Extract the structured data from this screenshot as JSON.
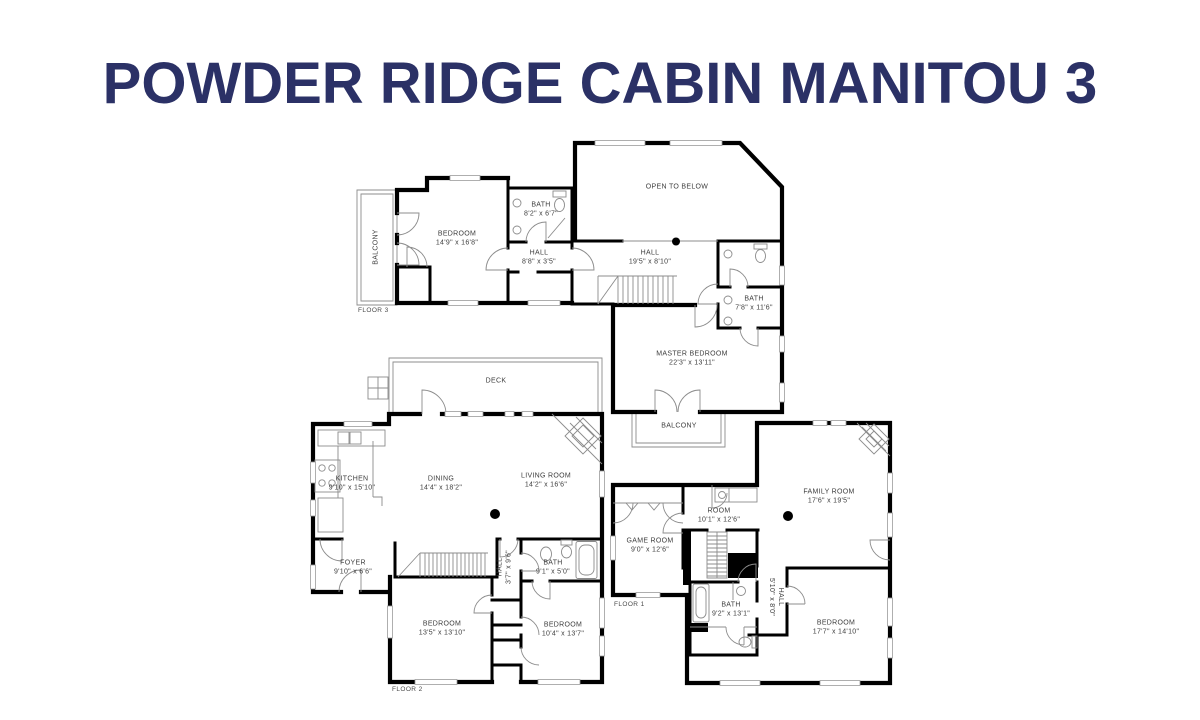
{
  "title": "POWDER RIDGE CABIN MANITOU 3",
  "colors": {
    "title": "#2b3166",
    "wall": "#000000",
    "thin": "#8c8c8c",
    "label": "#3d3d3d",
    "floor_label": "#4a4a4a"
  },
  "floor3": {
    "floor_label": "FLOOR 3",
    "rooms": {
      "balcony": {
        "name": "BALCONY"
      },
      "bedroom": {
        "name": "BEDROOM",
        "dims": "14'9\" x 16'8\""
      },
      "bath": {
        "name": "BATH",
        "dims": "8'2\" x 6'7\""
      },
      "hall": {
        "name": "HALL",
        "dims": "8'8\" x 3'5\""
      },
      "open_to_below": {
        "name": "OPEN TO BELOW"
      },
      "hall_main": {
        "name": "HALL",
        "dims": "19'5\" x 8'10\""
      },
      "bath_main": {
        "name": "BATH",
        "dims": "7'8\" x 11'6\""
      },
      "master_bedroom": {
        "name": "MASTER BEDROOM",
        "dims": "22'3\" x 13'11\""
      },
      "balcony_lower": {
        "name": "BALCONY"
      }
    }
  },
  "floor2": {
    "floor_label": "FLOOR 2",
    "rooms": {
      "deck": {
        "name": "DECK"
      },
      "kitchen": {
        "name": "KITCHEN",
        "dims": "9'10\" x 15'10\""
      },
      "dining": {
        "name": "DINING",
        "dims": "14'4\" x 18'2\""
      },
      "living_room": {
        "name": "LIVING ROOM",
        "dims": "14'2\" x 16'6\""
      },
      "foyer": {
        "name": "FOYER",
        "dims": "9'10\" x 6'6\""
      },
      "hall": {
        "name": "HALL",
        "dims": "3'7\" x 9'6\""
      },
      "bath": {
        "name": "BATH",
        "dims": "9'1\" x 5'0\""
      },
      "bedroom_left": {
        "name": "BEDROOM",
        "dims": "13'5\" x 13'10\""
      },
      "bedroom_right": {
        "name": "BEDROOM",
        "dims": "10'4\" x 13'7\""
      }
    }
  },
  "floor1": {
    "floor_label": "FLOOR 1",
    "rooms": {
      "room": {
        "name": "ROOM",
        "dims": "10'1\" x 12'6\""
      },
      "game_room": {
        "name": "GAME ROOM",
        "dims": "9'0\" x 12'6\""
      },
      "family_room": {
        "name": "FAMILY ROOM",
        "dims": "17'6\" x 19'5\""
      },
      "bath": {
        "name": "BATH",
        "dims": "9'2\" x 13'1\""
      },
      "hall": {
        "name": "HALL",
        "dims": "5'10\" x 8'0\""
      },
      "bedroom": {
        "name": "BEDROOM",
        "dims": "17'7\" x 14'10\""
      }
    }
  }
}
